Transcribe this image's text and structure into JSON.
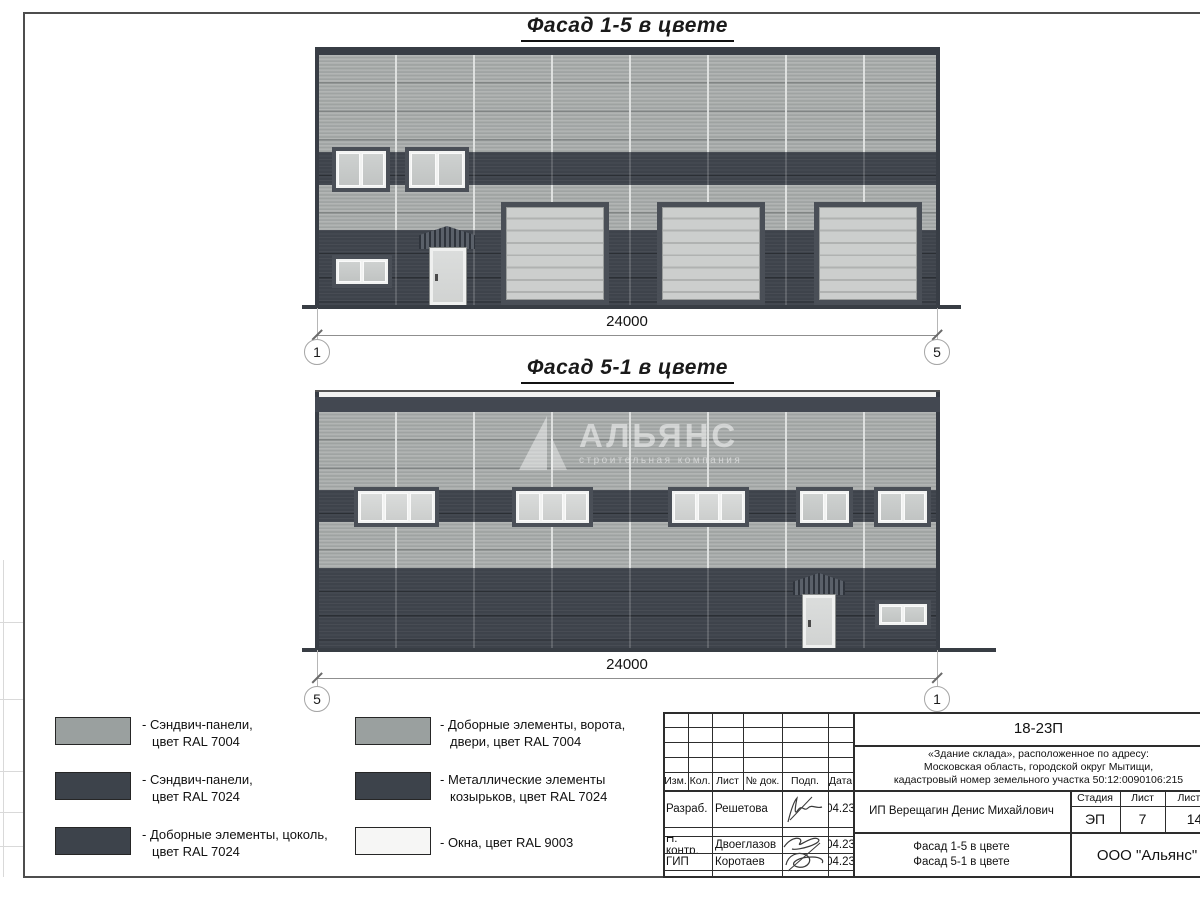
{
  "facade1": {
    "title": "Фасад 1-5 в цвете",
    "dim": "24000",
    "axis_left": "1",
    "axis_right": "5"
  },
  "facade2": {
    "title": "Фасад 5-1 в цвете",
    "dim": "24000",
    "axis_left": "5",
    "axis_right": "1"
  },
  "watermark": {
    "name": "АЛЬЯНС",
    "subtitle": "строительная компания"
  },
  "legend": {
    "items": [
      {
        "line1": "- Сэндвич-панели,",
        "line2": "цвет RAL 7004",
        "color": "#9aa09f"
      },
      {
        "line1": "- Сэндвич-панели,",
        "line2": "цвет RAL 7024",
        "color": "#3d434b"
      },
      {
        "line1": "- Доборные элементы, цоколь,",
        "line2": "цвет RAL 7024",
        "color": "#3d434b"
      },
      {
        "line1": "- Доборные элементы, ворота,",
        "line2": "двери, цвет RAL 7004",
        "color": "#9aa09f"
      },
      {
        "line1": "- Металлические элементы",
        "line2": "козырьков, цвет RAL 7024",
        "color": "#3d434b"
      },
      {
        "line1": "- Окна, цвет RAL 9003",
        "line2": "",
        "color": "#f6f6f5"
      }
    ]
  },
  "titleblock": {
    "doc_number": "18-23П",
    "address_line1": "«Здание склада», расположенное по адресу:",
    "address_line2": "Московская область, городской округ Мытищи,",
    "address_line3": "кадастровый номер земельного участка 50:12:0090106:215",
    "col_izm": "Изм.",
    "col_kol": "Кол.",
    "col_list": "Лист",
    "col_doc": "№ док.",
    "col_podp": "Подп.",
    "col_data": "Дата",
    "row1_role": "Разраб.",
    "row1_name": "Решетова",
    "row1_date": "04.23",
    "row2_role": "Н. контр.",
    "row2_name": "Двоеглазов",
    "row2_date": "04.23",
    "row3_role": "ГИП",
    "row3_name": "Коротаев",
    "row3_date": "04.23",
    "client": "ИП Верещагин Денис Михайлович",
    "stage_label": "Стадия",
    "stage": "ЭП",
    "sheet_label": "Лист",
    "sheet": "7",
    "sheets_label": "Листов",
    "sheets": "14",
    "title_line1": "Фасад 1-5 в цвете",
    "title_line2": "Фасад 5-1 в цвете",
    "company": "ООО \"Альянс\""
  },
  "colors": {
    "panel_light_ral7004": "#a3a7a6",
    "panel_dark_ral7024": "#3e434b",
    "window_ral9003": "#f2f3f2",
    "gate_ral7004": "#cccecd"
  }
}
